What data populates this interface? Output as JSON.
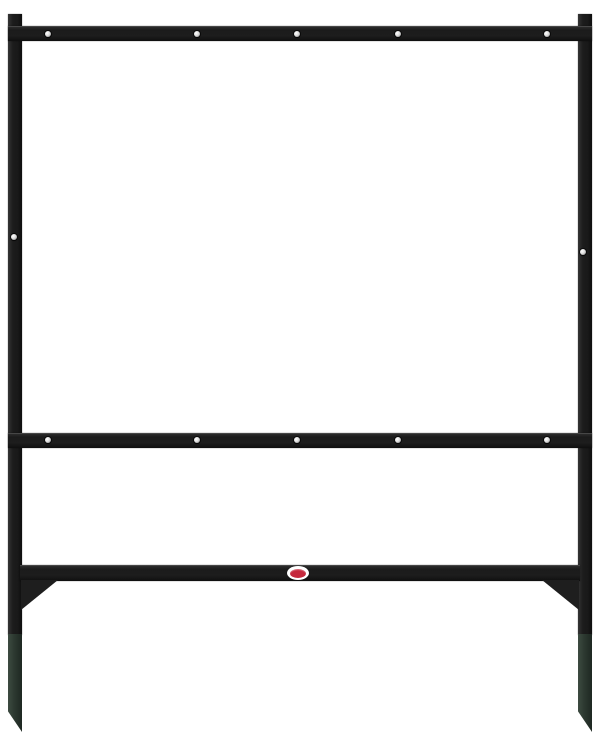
{
  "scene": {
    "type": "product-photo",
    "subject": "Black metal real-estate yard sign frame with rider bar and green ground stakes",
    "background_color": "#ffffff"
  },
  "colors": {
    "metal": "#1e1e1e",
    "metal_dark": "#121212",
    "metal_highlight": "#3f3f3f",
    "stake": "#2c3830",
    "stake_light": "#3d4c41",
    "stake_dark": "#1e2822",
    "rivet": "#dedede",
    "rivet_shadow": "#777777",
    "label_outer": "#ffffff",
    "label_inner": "#c5293d",
    "bg": "#ffffff"
  },
  "rivets": {
    "size": 6,
    "top_bar": {
      "y": 34,
      "xs": [
        48,
        197,
        297,
        398,
        547
      ]
    },
    "middle_bar": {
      "y": 440,
      "xs": [
        48,
        197,
        297,
        398,
        547
      ]
    },
    "posts": [
      {
        "x": 14,
        "y": 237
      },
      {
        "x": 583,
        "y": 252
      }
    ]
  }
}
